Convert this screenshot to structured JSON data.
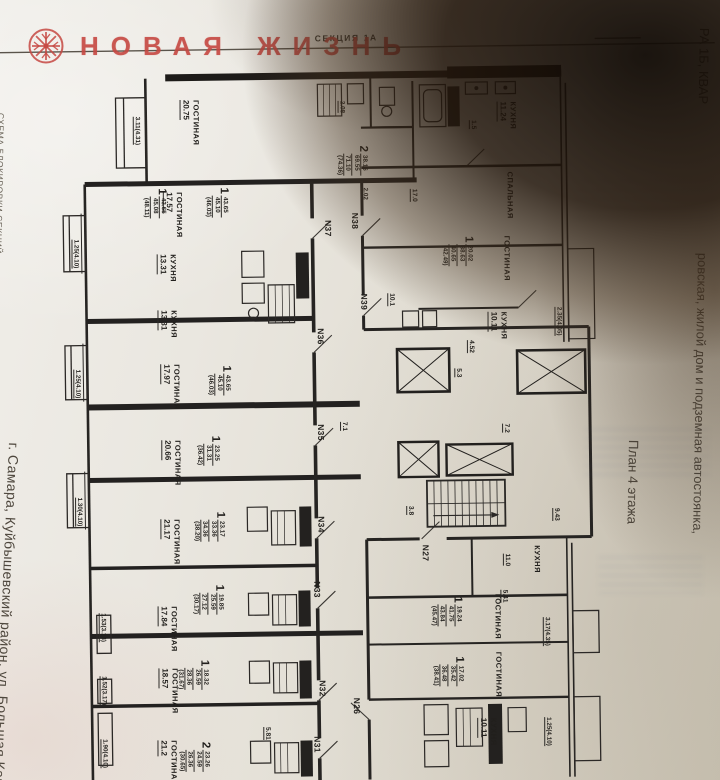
{
  "logo": {
    "brand": "НОВАЯ ЖИЗНЬ",
    "accent_color": "#c64842"
  },
  "margin_notes": {
    "left_top": "СХЕМА БЛОКИРОВКИ СЕКЦИЙ",
    "left_bottom": "г. Самара, Куйбышевский район, ул. Большая Кара",
    "right_top": "РА 1Б, КВАР",
    "right_outer": "ровская, жилой дом и подземная автостоянка,",
    "right_inner": "План 4 этажа"
  },
  "plan": {
    "section": "СЕКЦИЯ 1А",
    "rooms": [
      {
        "label": "ГОСТИНАЯ",
        "area": "20.75"
      },
      {
        "label": "ГОСТИНАЯ",
        "area": "17.57"
      },
      {
        "label": "КУХНЯ",
        "area": "13.31"
      },
      {
        "label": "КУХНЯ",
        "area": "13.31"
      },
      {
        "label": "ГОСТИНАЯ",
        "area": "17.97"
      },
      {
        "label": "ГОСТИНАЯ",
        "area": "20.66"
      },
      {
        "label": "ГОСТИНАЯ",
        "area": "21.17"
      },
      {
        "label": "ГОСТИНАЯ",
        "area": "17.84"
      },
      {
        "label": "ГОСТИНАЯ",
        "area": "18.57"
      },
      {
        "label": "ГОСТИНАЯ",
        "area": "21.2"
      },
      {
        "label": "КУХНЯ",
        "area": "11.24"
      },
      {
        "label": "СПАЛЬНАЯ",
        "area": ""
      },
      {
        "label": "ГОСТИНАЯ",
        "area": ""
      },
      {
        "label": "КУХНЯ",
        "area": "10.11"
      },
      {
        "label": "КУХНЯ",
        "area": ""
      },
      {
        "label": "ГОСТИНАЯ",
        "area": ""
      },
      {
        "label": "ГОСТИНАЯ",
        "area": ""
      },
      {
        "label": "КУХНЯ",
        "area": "10.11"
      }
    ],
    "apartments": [
      "N37",
      "N38",
      "N39",
      "N36",
      "N35",
      "N34",
      "N33",
      "N32",
      "N31",
      "N26",
      "N27"
    ],
    "units": [
      {
        "rooms": "2",
        "areas": [
          "38.16",
          "69.55",
          "71.10",
          "(74.36)"
        ]
      },
      {
        "rooms": "1",
        "areas": [
          "43.65",
          "45.08",
          "(48.11)"
        ]
      },
      {
        "rooms": "1",
        "areas": [
          "43.65",
          "45.10",
          "(46.03)"
        ]
      },
      {
        "rooms": "1",
        "areas": [
          "43.65",
          "45.10",
          "(46.03)"
        ]
      },
      {
        "rooms": "1",
        "areas": [
          "23.25",
          "31.31",
          "(36.42)"
        ]
      },
      {
        "rooms": "1",
        "areas": [
          "23.17",
          "33.36",
          "34.36",
          "(38.20)"
        ]
      },
      {
        "rooms": "1",
        "areas": [
          "19.85",
          "25.59",
          "27.12",
          "(30.17)"
        ]
      },
      {
        "rooms": "1",
        "areas": [
          "18.32",
          "26.59",
          "28.36",
          "(31.67)"
        ]
      },
      {
        "rooms": "2",
        "areas": [
          "23.26",
          "24.59",
          "26.36",
          "(30.65)"
        ]
      },
      {
        "rooms": "1",
        "areas": [
          "20.02",
          "38.63",
          "40.65",
          "(42.49)"
        ]
      },
      {
        "rooms": "1",
        "areas": [
          "19.24",
          "41.75",
          "43.84",
          "(45.47)"
        ]
      },
      {
        "rooms": "1",
        "areas": [
          "17.02",
          "35.42",
          "36.48",
          "(38.41)"
        ]
      }
    ],
    "dims": [
      "3.11(4.31)",
      "1.25(4.10)",
      "1.25(4.10)",
      "1.30(4.10)",
      "1.53(3.13)",
      "1.52(3.17)",
      "1.90(4.10)",
      "2.35(4.05)",
      "3.17(4.35)",
      "1.25(4.10)",
      "2.02",
      "2.08"
    ],
    "small_areas": [
      "17.0",
      "4.52",
      "5.3",
      "7.1",
      "7.2",
      "3.8",
      "9.43",
      "5.41",
      "11.0",
      "5.81",
      "1.5",
      "10.1"
    ]
  }
}
